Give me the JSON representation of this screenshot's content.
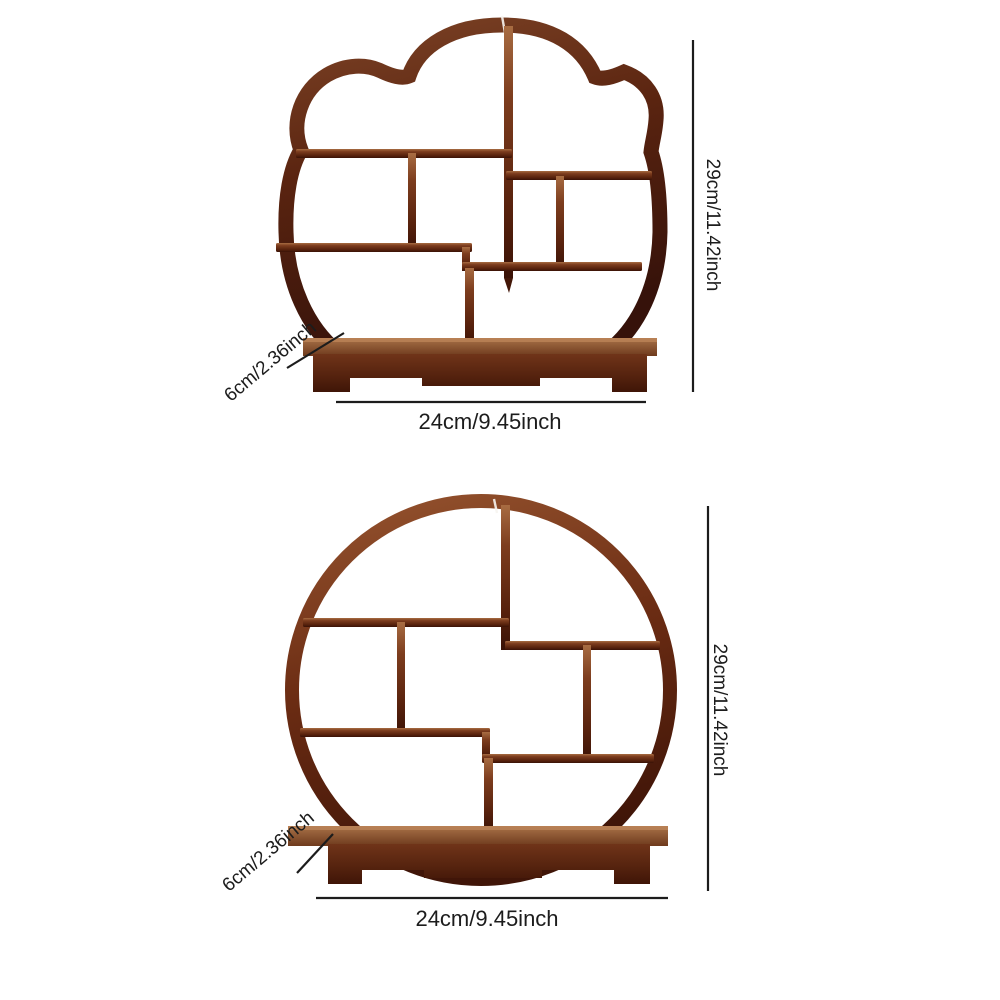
{
  "page": {
    "background": "#ffffff",
    "description": "Product dimension diagram of two wooden curio display shelves"
  },
  "colors": {
    "dimension_line": "#1c1c1c",
    "label_text": "#1c1c1c",
    "wood_dark": "#3a1206",
    "wood_mid": "#5a2410",
    "wood_light": "#a86c42",
    "base_top": "#a97248",
    "base_front": "#6e3318"
  },
  "figures": [
    {
      "id": "plum-blossom-shelf",
      "shape": "plum-blossom",
      "height_label": "29cm/11.42inch",
      "width_label": "24cm/9.45inch",
      "depth_label": "6cm/2.36inch"
    },
    {
      "id": "round-shelf",
      "shape": "round",
      "height_label": "29cm/11.42inch",
      "width_label": "24cm/9.45inch",
      "depth_label": "6cm/2.36inch"
    }
  ]
}
